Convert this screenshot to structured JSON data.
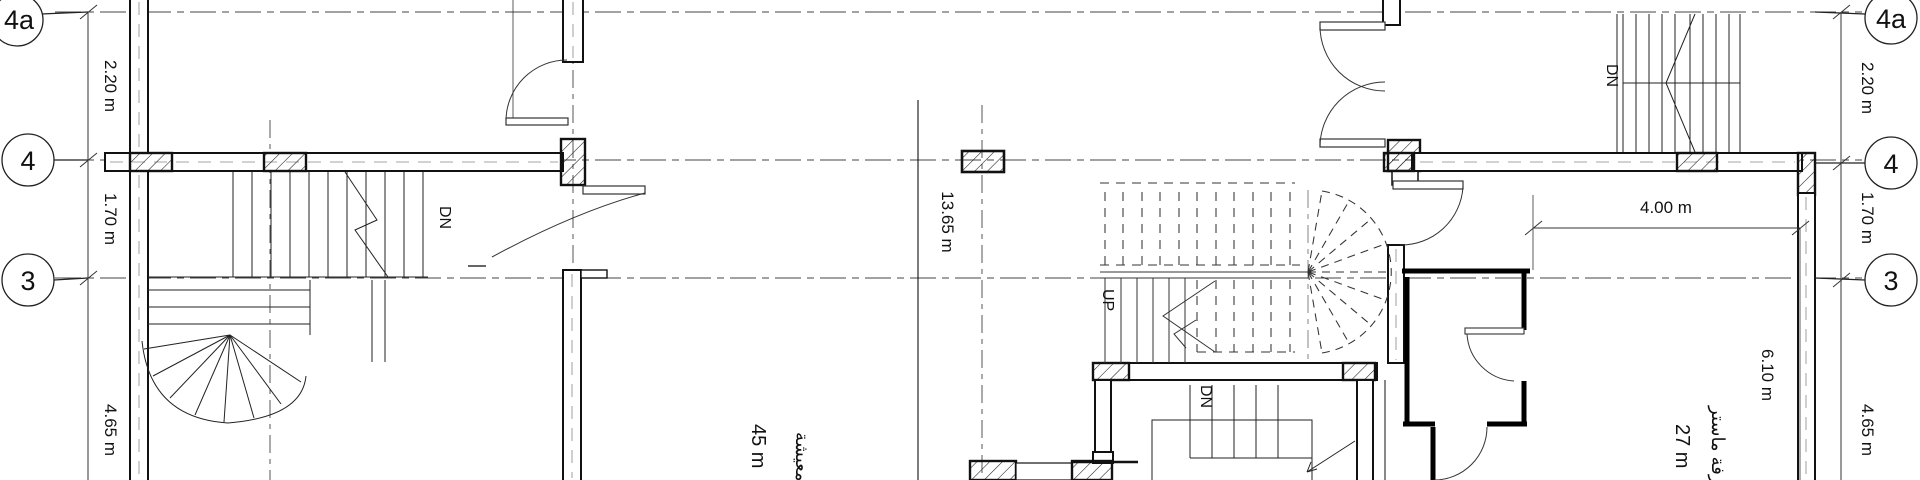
{
  "canvas": {
    "background": "#ffffff",
    "line_color": "#1a1a1a"
  },
  "grid": {
    "left_bubbles": [
      {
        "label": "4a"
      },
      {
        "label": "4"
      },
      {
        "label": "3"
      }
    ],
    "right_bubbles": [
      {
        "label": "4a"
      },
      {
        "label": "4"
      },
      {
        "label": "3"
      }
    ]
  },
  "dimensions": {
    "left": [
      {
        "value": "2.20 m"
      },
      {
        "value": "1.70 m"
      },
      {
        "value": "4.65 m"
      }
    ],
    "right": [
      {
        "value": "2.20 m"
      },
      {
        "value": "1.70 m"
      },
      {
        "value": "4.65 m"
      }
    ],
    "center_total": "13.65 m",
    "room_width": "4.00 m",
    "room_depth": "6.10 m"
  },
  "stairs": {
    "left_down": "DN",
    "center_up": "UP",
    "center_down": "DN",
    "right_down": "DN"
  },
  "rooms": {
    "living": {
      "name": "معيشة",
      "area": "45 m"
    },
    "master": {
      "name": "غرفة ماستر",
      "area": "27 m"
    }
  }
}
